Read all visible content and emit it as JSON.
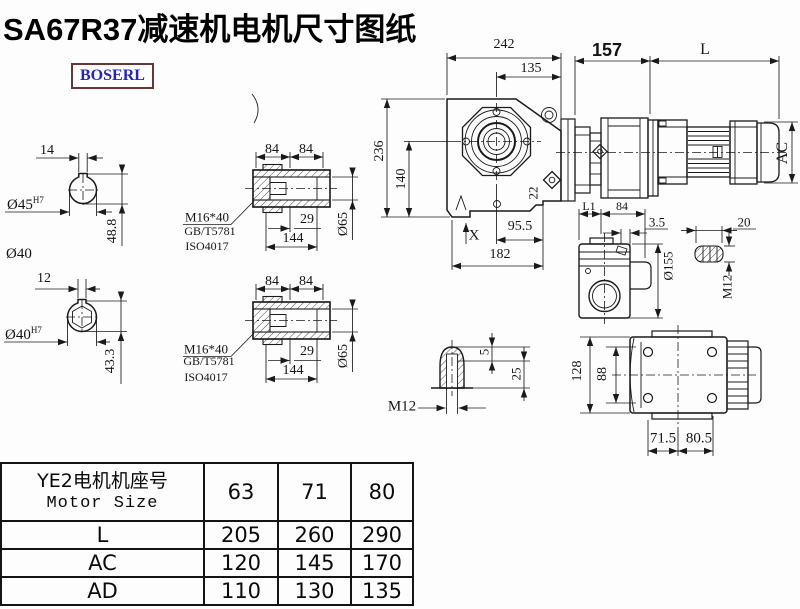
{
  "title": "SA67R37减速机电机尺寸图纸",
  "logo": "BOSERL",
  "colors": {
    "line": "#1a1a1a",
    "logo_text": "#2222c8",
    "logo_border": "#6b3535",
    "background": "#fdfdfd"
  },
  "solid_shaft_top": {
    "keyway_width": "14",
    "bore": "Ø45",
    "bore_fit": "H7",
    "keyway_height": "48.8",
    "outer_dia": "Ø40"
  },
  "solid_shaft_bottom": {
    "keyway_width": "12",
    "bore": "Ø40",
    "bore_fit": "H7",
    "keyway_height": "43.3"
  },
  "hollow_shaft_top": {
    "len_a": "84",
    "len_b": "84",
    "thread": "M16*40",
    "std1": "GB/T5781",
    "std2": "ISO4017",
    "depth": "29",
    "length": "144",
    "dia": "Ø65"
  },
  "hollow_shaft_bottom": {
    "len_a": "84",
    "len_b": "84",
    "thread": "M16*40",
    "std1": "GB/T5781",
    "std2": "ISO4017",
    "depth": "29",
    "length": "144",
    "dia": "Ø65"
  },
  "front_view": {
    "width": "242",
    "center_to_right": "135",
    "height": "236",
    "center_height": "140",
    "plug": "22",
    "center_to_foot": "95.5",
    "foot_width": "182",
    "marker": "X"
  },
  "side_assembly": {
    "gear_length": "157",
    "motor_length": "L",
    "motor_dia": "AC"
  },
  "side_view": {
    "dim_l1": "L1",
    "dim_84": "84",
    "offset": "3.5",
    "flange_dia": "Ø155",
    "key_len": "20",
    "thread": "M12"
  },
  "plug_detail": {
    "depth": "5",
    "length": "25",
    "thread": "M12"
  },
  "bottom_view": {
    "height": "128",
    "inner_height": "88",
    "foot_a": "71.5",
    "foot_b": "80.5"
  },
  "table": {
    "header_cn": "YE2电机机座号",
    "header_en": "Motor Size",
    "sizes": [
      "63",
      "71",
      "80"
    ],
    "rows": [
      {
        "label": "L",
        "values": [
          "205",
          "260",
          "290"
        ]
      },
      {
        "label": "AC",
        "values": [
          "120",
          "145",
          "170"
        ]
      },
      {
        "label": "AD",
        "values": [
          "110",
          "130",
          "135"
        ]
      }
    ]
  }
}
